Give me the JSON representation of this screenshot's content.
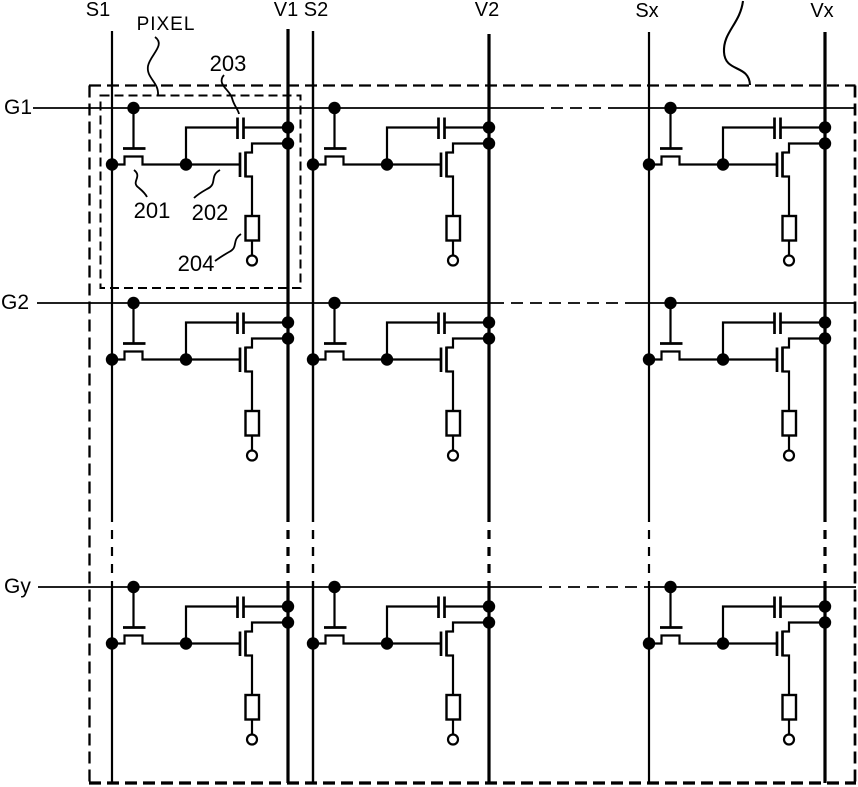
{
  "colors": {
    "ink": "#000000",
    "paper": "#ffffff"
  },
  "column_labels": [
    "S1",
    "V1",
    "S2",
    "V2",
    "Sx",
    "Vx"
  ],
  "row_labels": [
    "G1",
    "G2",
    "Gy"
  ],
  "callouts": {
    "pixel": "PIXEL",
    "ref_201": "201",
    "ref_202": "202",
    "ref_203": "203",
    "ref_204": "204"
  }
}
